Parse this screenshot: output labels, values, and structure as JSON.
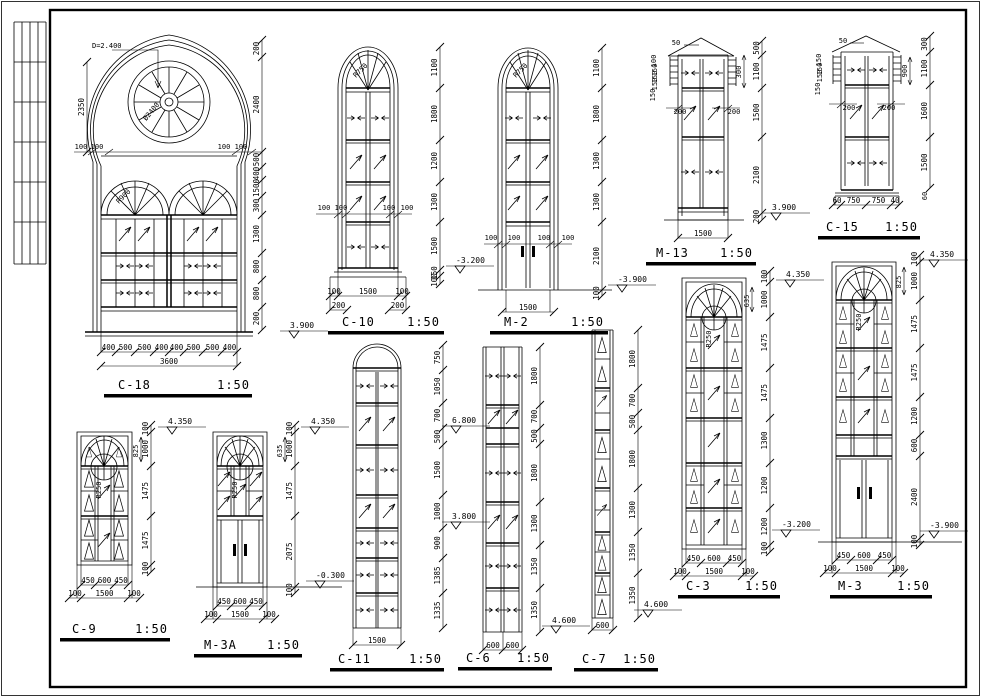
{
  "sheet": {
    "background": "#ffffff",
    "line_color": "#000000"
  },
  "details": {
    "c18": {
      "title": "C-18",
      "scale": "1:50",
      "diameter_note": "D=2.400",
      "rose_label": "Ø2400",
      "arch_label": "R900",
      "left_dim": "2350",
      "jamb_dims": [
        "100",
        "100",
        "100",
        "100"
      ],
      "right_dims": [
        "200",
        "2400",
        "500",
        "400",
        "1500",
        "300",
        "1300",
        "800",
        "800",
        "200"
      ],
      "bottom_dims": [
        "400",
        "500",
        "500",
        "400",
        "400",
        "500",
        "500",
        "400"
      ],
      "total_width": "3600",
      "level": "3.900"
    },
    "c10": {
      "title": "C-10",
      "scale": "1:50",
      "arch_label": "R750",
      "jamb_dims": [
        "100",
        "100",
        "100",
        "100"
      ],
      "right_dims": [
        "1100",
        "1800",
        "1200",
        "1300",
        "1500",
        "150",
        "100"
      ],
      "bottom_dims": [
        "100",
        "1500",
        "100"
      ],
      "left_edge_dim": [
        "200"
      ],
      "right_edge_dim": [
        "200"
      ],
      "level": "-3.200"
    },
    "m2": {
      "title": "M-2",
      "scale": "1:50",
      "arch_label": "R750",
      "jamb_dims": [
        "100",
        "100",
        "100",
        "100"
      ],
      "right_dims": [
        "1100",
        "1800",
        "1300",
        "1300",
        "2100",
        "100"
      ],
      "bottom_dims": [
        "1500"
      ],
      "level_right": "-3.900"
    },
    "m13": {
      "title": "M-13",
      "scale": "1:50",
      "ridge_dim": "50",
      "left_dims": [
        "100",
        "150",
        "150",
        "150",
        "150"
      ],
      "side_dims": [
        "200",
        "200"
      ],
      "right_dims": [
        "500",
        "1100",
        "1500",
        "2100",
        "200"
      ],
      "inner_dim": "300",
      "bottom_dims": [
        "1500"
      ],
      "level": "3.900"
    },
    "c15": {
      "title": "C-15",
      "scale": "1:50",
      "ridge_dim": "50",
      "left_dims": [
        "150",
        "150",
        "150",
        "150"
      ],
      "side_dims": [
        "200",
        "200"
      ],
      "right_dims": [
        "300",
        "1100",
        "1600",
        "1500"
      ],
      "inner_dim": "900",
      "sill_dim": "60",
      "bottom_dims": [
        "60",
        "750",
        "750",
        "40"
      ]
    },
    "c9": {
      "title": "C-9",
      "scale": "1:50",
      "circle_label": "R250",
      "right_dims": [
        "100",
        "1000",
        "1475",
        "1475",
        "100"
      ],
      "inner_dim": "825",
      "level": "4.350",
      "bottom_dims": [
        "450",
        "600",
        "450"
      ],
      "bottom_dims2": [
        "100",
        "1500",
        "100"
      ]
    },
    "m3a": {
      "title": "M-3A",
      "scale": "1:50",
      "circle_label": "R250",
      "right_dims": [
        "100",
        "1000",
        "1475",
        "2075",
        "100"
      ],
      "inner_dim": "635",
      "level_top": "4.350",
      "level_bottom": "-0.300",
      "bottom_dims": [
        "450",
        "600",
        "450"
      ],
      "bottom_dims2": [
        "100",
        "1500",
        "100"
      ]
    },
    "c11": {
      "title": "C-11",
      "scale": "1:50",
      "right_dims": [
        "750",
        "1050",
        "700",
        "500",
        "1500",
        "1000",
        "900",
        "1385",
        "1335"
      ],
      "level_upper": "6.800",
      "level_lower": "3.800",
      "bottom_dims": [
        "1500"
      ]
    },
    "c6": {
      "title": "C-6",
      "scale": "1:50",
      "right_dims": [
        "1800",
        "700",
        "500",
        "1800",
        "1300",
        "1350",
        "1350"
      ],
      "level": "4.600",
      "bottom_dims": [
        "600",
        "600"
      ]
    },
    "c7": {
      "title": "C-7",
      "scale": "1:50",
      "right_dims": [
        "1800",
        "700",
        "500",
        "1800",
        "1300",
        "1350",
        "1350"
      ],
      "level": "4.600",
      "bottom_dims": [
        "600"
      ]
    },
    "c3": {
      "title": "C-3",
      "scale": "1:50",
      "circle_label": "R250",
      "right_dims": [
        "100",
        "1000",
        "1475",
        "1475",
        "1300",
        "1200",
        "1200",
        "100"
      ],
      "inner_dim": "635",
      "level_top": "4.350",
      "level_bottom": "-3.200",
      "bottom_dims": [
        "450",
        "600",
        "450"
      ],
      "bottom_dims2": [
        "100",
        "1500",
        "100"
      ]
    },
    "m3": {
      "title": "M-3",
      "scale": "1:50",
      "circle_label": "R250",
      "right_dims": [
        "100",
        "1000",
        "1475",
        "1475",
        "1200",
        "600",
        "2400",
        "100"
      ],
      "inner_dim": "825",
      "level_top": "4.350",
      "level_bottom": "-3.900",
      "bottom_dims": [
        "450",
        "600",
        "450"
      ],
      "bottom_dims2": [
        "100",
        "1500",
        "100"
      ]
    }
  }
}
